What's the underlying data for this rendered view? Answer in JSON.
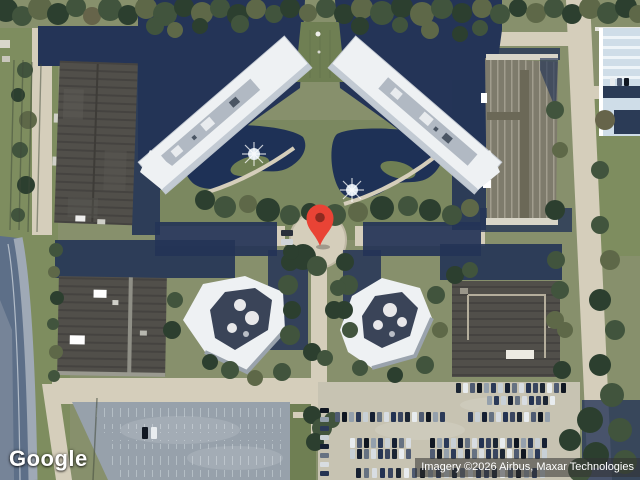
{
  "map": {
    "view": "satellite",
    "logo_text": "Google",
    "attribution_text": "Imagery ©2026 Airbus, Maxar Technologies"
  },
  "marker": {
    "color": "#E94335",
    "inner_color": "#8E2A20"
  },
  "palette": {
    "water": "#1e3156",
    "shadow": "#243457",
    "grassLight": "#7e8d5f",
    "grassDark": "#6f7f53",
    "road": "#d5cebb",
    "asphalt": "#97a1ab",
    "lotTan": "#c7c3b2",
    "bldgWhite": "#eef1f3",
    "bldgWhiteShade": "#b7c0ca",
    "bldgBlue": "#cfdde8",
    "courtyard": "#3a4458",
    "treeDark": "#2c3f2f",
    "tree": "#41543d",
    "treeOlive": "#5e6848",
    "treeBrown": "#66644a",
    "highway": "#5d6f88",
    "pin": "#E94335",
    "pinInner": "#8E2A20",
    "attrBg": "rgba(50,50,50,0.55)"
  },
  "parking": {
    "car_colors": [
      "#1c2634",
      "#e8ecef",
      "#4f5b72",
      "#101722",
      "#94a0ac",
      "#2b3a58",
      "#c8d0d6",
      "#162032",
      "#667282",
      "#d8dde2",
      "#243352",
      "#3a4660"
    ],
    "rows": [
      {
        "x": 456,
        "y": 383,
        "count": 16,
        "step": 7,
        "w": 5,
        "h": 10
      },
      {
        "x": 487,
        "y": 396,
        "count": 10,
        "step": 7,
        "w": 5,
        "h": 9,
        "c0": 4
      },
      {
        "x": 335,
        "y": 412,
        "count": 16,
        "step": 7,
        "w": 5,
        "h": 10,
        "c0": 2
      },
      {
        "x": 468,
        "y": 412,
        "count": 12,
        "step": 7,
        "w": 5,
        "h": 10,
        "c0": 5
      },
      {
        "x": 350,
        "y": 438,
        "count": 9,
        "step": 7,
        "w": 5,
        "h": 10,
        "c0": 1
      },
      {
        "x": 430,
        "y": 438,
        "count": 17,
        "step": 7,
        "w": 5,
        "h": 10,
        "c0": 3
      },
      {
        "x": 350,
        "y": 449,
        "count": 9,
        "step": 7,
        "w": 5,
        "h": 10,
        "c0": 6
      },
      {
        "x": 430,
        "y": 449,
        "count": 17,
        "step": 7,
        "w": 5,
        "h": 10,
        "c0": 2
      },
      {
        "x": 356,
        "y": 468,
        "count": 24,
        "step": 8,
        "w": 5,
        "h": 10,
        "c0": 7
      },
      {
        "x": 320,
        "y": 408,
        "count": 8,
        "step": 9,
        "w": 9,
        "h": 5,
        "vertical": true,
        "c0": 3
      },
      {
        "x": 610,
        "y": 78,
        "count": 3,
        "step": 7,
        "w": 5,
        "h": 8,
        "c0": 1
      },
      {
        "x": 142,
        "y": 427,
        "count": 2,
        "step": 9,
        "w": 6,
        "h": 12,
        "colors": [
          "#101722",
          "#e8ecef"
        ]
      },
      {
        "x": 281,
        "y": 230,
        "count": 2,
        "step": 9,
        "w": 12,
        "h": 6,
        "vertical": true,
        "colors": [
          "#2a2f3a",
          "#cfd4d8"
        ],
        "step2": 0
      }
    ]
  }
}
